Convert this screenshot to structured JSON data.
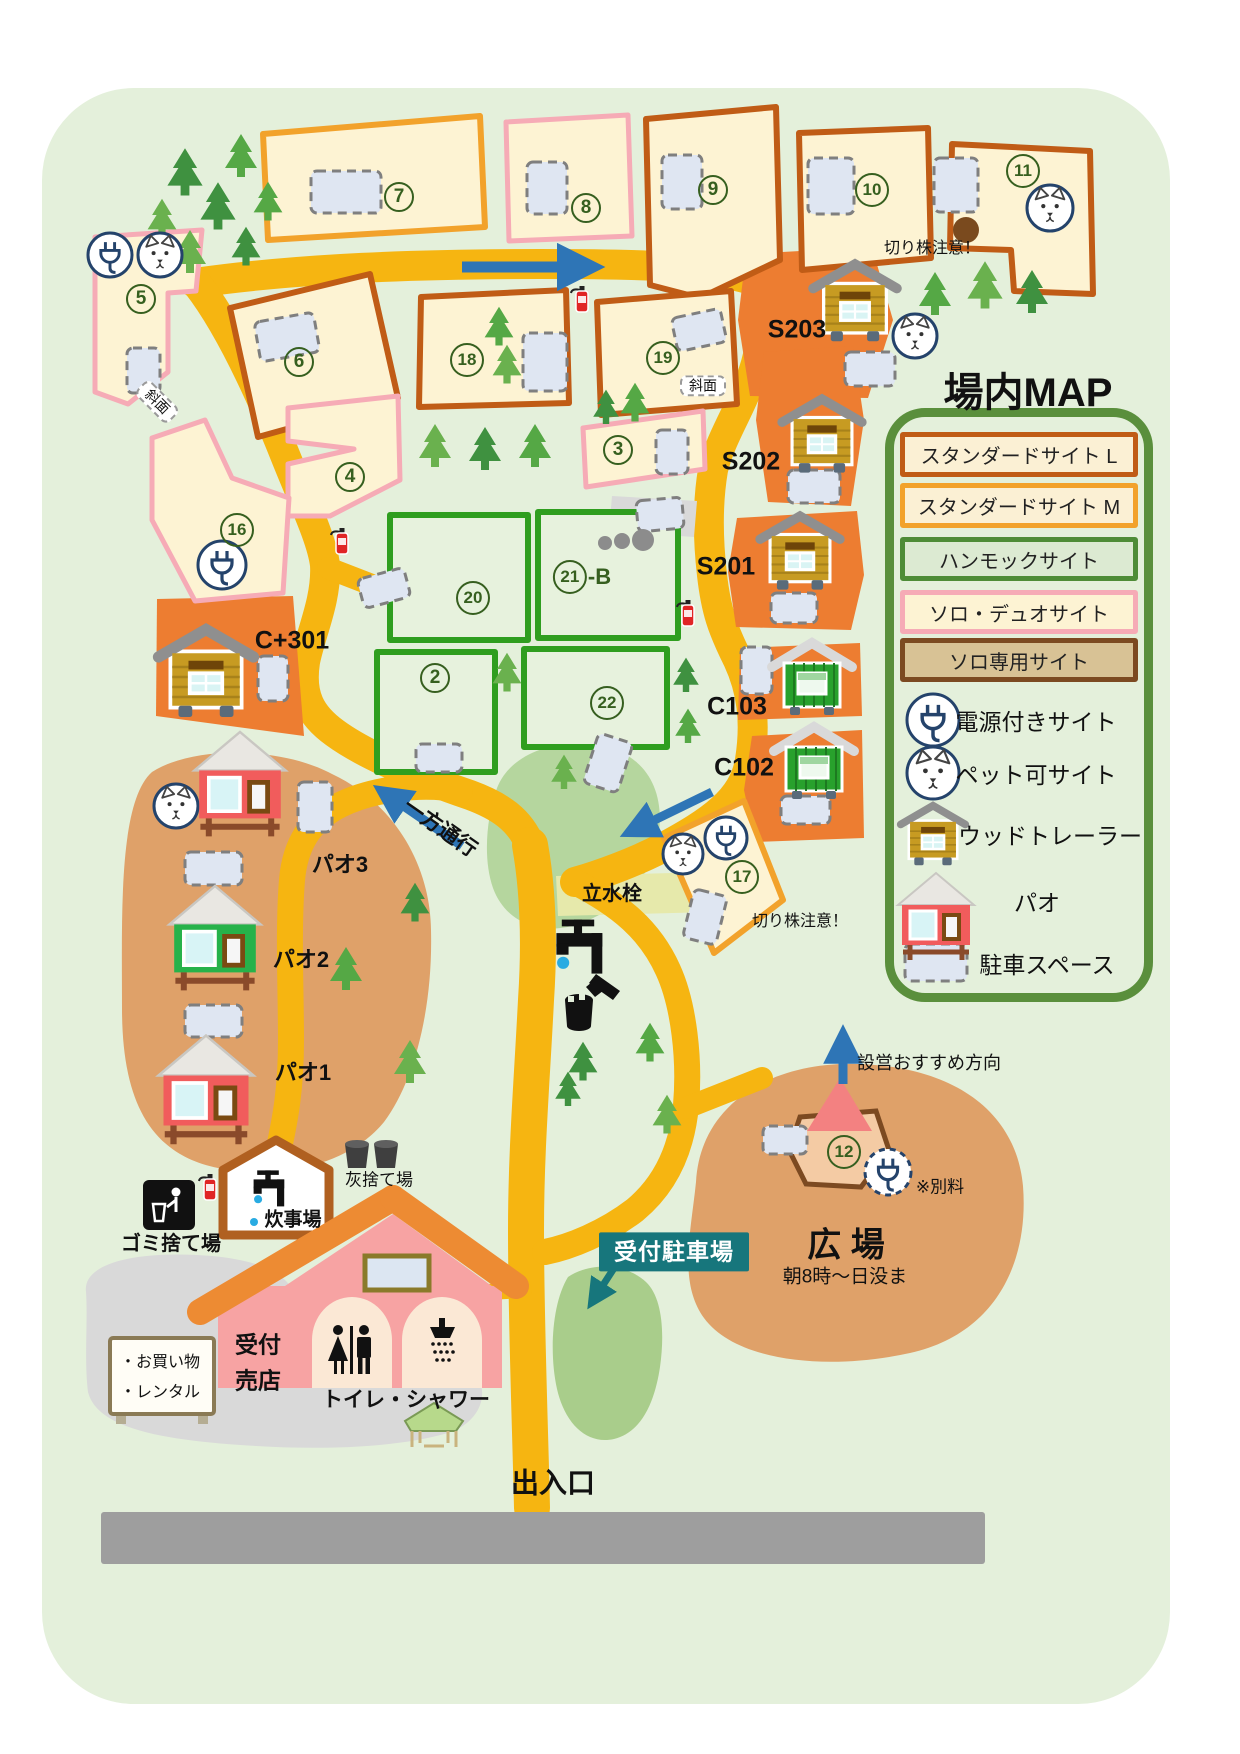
{
  "title": "場内MAP",
  "legend": {
    "items": [
      {
        "label": "スタンダードサイト L",
        "border": "#c05c16",
        "fill": "#fbf0d4"
      },
      {
        "label": "スタンダードサイト M",
        "border": "#f2a22b",
        "fill": "#fbf0d4"
      },
      {
        "label": "ハンモックサイト",
        "border": "#4e8c37",
        "fill": "#dcead2"
      },
      {
        "label": "ソロ・デュオサイト",
        "border": "#f6abb6",
        "fill": "#fdf3d3"
      },
      {
        "label": "ソロ専用サイト",
        "border": "#7c4a21",
        "fill": "#d8c295"
      }
    ],
    "icon_items": [
      {
        "icon": "power-plug-icon",
        "label": "電源付きサイト"
      },
      {
        "icon": "dog-icon",
        "label": "ペット可サイト"
      },
      {
        "icon": "wood-trailer-icon",
        "label": "ウッドトレーラー"
      },
      {
        "icon": "pao-icon",
        "label": "パオ"
      },
      {
        "icon": "parking-icon",
        "label": "駐車スペース"
      }
    ]
  },
  "colors": {
    "map_background": "#e4f0db",
    "road": "#f6b511",
    "arrow_blue": "#2e75b6",
    "teal": "#17767c",
    "trailer_patch": "#ed7d31",
    "pao_area": "#dfa169",
    "plaza_area": "#dfa169",
    "parking_fill": "#dfe6f2",
    "bottom_road": "#9e9e9e"
  },
  "sites": [
    {
      "n": "7",
      "x": 399,
      "y": 197
    },
    {
      "n": "8",
      "x": 586,
      "y": 208
    },
    {
      "n": "9",
      "x": 713,
      "y": 190
    },
    {
      "n": "10",
      "x": 872,
      "y": 190
    },
    {
      "n": "11",
      "x": 1023,
      "y": 171
    },
    {
      "n": "5",
      "x": 141,
      "y": 299
    },
    {
      "n": "6",
      "x": 299,
      "y": 362
    },
    {
      "n": "4",
      "x": 350,
      "y": 477
    },
    {
      "n": "16",
      "x": 237,
      "y": 530
    },
    {
      "n": "18",
      "x": 467,
      "y": 360
    },
    {
      "n": "19",
      "x": 663,
      "y": 358
    },
    {
      "n": "3",
      "x": 618,
      "y": 450
    },
    {
      "n": "20",
      "x": 473,
      "y": 598
    },
    {
      "n": "21",
      "sfx": "-B",
      "x": 582,
      "y": 577
    },
    {
      "n": "2",
      "x": 435,
      "y": 678
    },
    {
      "n": "22",
      "x": 607,
      "y": 703
    },
    {
      "n": "17",
      "x": 742,
      "y": 877
    },
    {
      "n": "12",
      "x": 844,
      "y": 1152
    }
  ],
  "labels": [
    {
      "id": "map-title",
      "t": "場内MAP",
      "x": 1028,
      "y": 393,
      "s": 40,
      "w": 700
    },
    {
      "id": "site-s203-label",
      "t": "S203",
      "x": 797,
      "y": 330,
      "s": 25,
      "w": 700
    },
    {
      "id": "site-s202-label",
      "t": "S202",
      "x": 751,
      "y": 462,
      "s": 25,
      "w": 700
    },
    {
      "id": "site-s201-label",
      "t": "S201",
      "x": 726,
      "y": 567,
      "s": 25,
      "w": 700
    },
    {
      "id": "site-c103-label",
      "t": "C103",
      "x": 737,
      "y": 707,
      "s": 25,
      "w": 700
    },
    {
      "id": "site-c102-label",
      "t": "C102",
      "x": 744,
      "y": 768,
      "s": 25,
      "w": 700
    },
    {
      "id": "site-c301-label",
      "t": "C+301",
      "x": 292,
      "y": 641,
      "s": 25,
      "w": 700
    },
    {
      "id": "pao3-label",
      "t": "パオ3",
      "x": 340,
      "y": 865,
      "s": 22,
      "w": 700
    },
    {
      "id": "pao2-label",
      "t": "パオ2",
      "x": 301,
      "y": 960,
      "s": 22,
      "w": 700
    },
    {
      "id": "pao1-label",
      "t": "パオ1",
      "x": 303,
      "y": 1073,
      "s": 22,
      "w": 700
    },
    {
      "id": "stump-warning-top",
      "t": "切り株注意！",
      "x": 932,
      "y": 249,
      "s": 16,
      "w": 400
    },
    {
      "id": "stump-warning-bottom",
      "t": "切り株注意！",
      "x": 800,
      "y": 922,
      "s": 16,
      "w": 400
    },
    {
      "id": "slope-note-site5",
      "t": "斜面",
      "x": 157,
      "y": 402,
      "s": 14,
      "w": 400,
      "rot": 45,
      "boxed": true
    },
    {
      "id": "slope-note-site19",
      "t": "斜面",
      "x": 703,
      "y": 386,
      "s": 14,
      "w": 400,
      "boxed": true
    },
    {
      "id": "one-way-label",
      "t": "一方通行",
      "x": 440,
      "y": 828,
      "s": 21,
      "w": 700,
      "rot": 35
    },
    {
      "id": "standpipe-label",
      "t": "立水栓",
      "x": 612,
      "y": 894,
      "s": 20,
      "w": 700
    },
    {
      "id": "setup-direction-label",
      "t": "設営おすすめ方向",
      "x": 929,
      "y": 1064,
      "s": 18,
      "w": 400
    },
    {
      "id": "extra-fee-note",
      "t": "※別料",
      "x": 940,
      "y": 1188,
      "s": 17,
      "w": 400
    },
    {
      "id": "plaza-label",
      "t": "広 場",
      "x": 846,
      "y": 1246,
      "s": 34,
      "w": 700
    },
    {
      "id": "plaza-hours",
      "t": "朝8時～日没ま",
      "x": 845,
      "y": 1278,
      "s": 19,
      "w": 400
    },
    {
      "id": "reception-parking-badge",
      "t": "受付駐車場",
      "x": 674,
      "y": 1252,
      "s": 23,
      "w": 700,
      "badge": true
    },
    {
      "id": "trash-area-label",
      "t": "ゴミ捨て場",
      "x": 171,
      "y": 1244,
      "s": 20,
      "w": 700
    },
    {
      "id": "cooking-area-label",
      "t": "炊事場",
      "x": 293,
      "y": 1221,
      "s": 19,
      "w": 700
    },
    {
      "id": "ash-area-label",
      "t": "灰捨て場",
      "x": 379,
      "y": 1181,
      "s": 17,
      "w": 400
    },
    {
      "id": "reception-label",
      "t": "受付",
      "x": 258,
      "y": 1345,
      "s": 23,
      "w": 700
    },
    {
      "id": "shop-label",
      "t": "売店",
      "x": 258,
      "y": 1381,
      "s": 23,
      "w": 700
    },
    {
      "id": "sign-shopping",
      "t": "・お買い物",
      "x": 120,
      "y": 1363,
      "s": 16,
      "w": 400,
      "anchor": "left"
    },
    {
      "id": "sign-rental",
      "t": "・レンタル",
      "x": 120,
      "y": 1393,
      "s": 16,
      "w": 400,
      "anchor": "left"
    },
    {
      "id": "toilet-shower-label",
      "t": "トイレ・シャワー",
      "x": 406,
      "y": 1400,
      "s": 21,
      "w": 700
    },
    {
      "id": "entrance-label",
      "t": "出入口",
      "x": 553,
      "y": 1484,
      "s": 28,
      "w": 700
    }
  ],
  "map_features": {
    "trees": [
      [
        185,
        179,
        1.1
      ],
      [
        241,
        162,
        1.0
      ],
      [
        162,
        224,
        0.9
      ],
      [
        218,
        213,
        1.1
      ],
      [
        268,
        207,
        0.9
      ],
      [
        190,
        258,
        1.0
      ],
      [
        246,
        252,
        0.9
      ],
      [
        935,
        300,
        1.0
      ],
      [
        985,
        292,
        1.1
      ],
      [
        1032,
        298,
        1.0
      ],
      [
        499,
        332,
        0.9
      ],
      [
        507,
        370,
        0.9
      ],
      [
        606,
        412,
        0.8
      ],
      [
        635,
        408,
        0.9
      ],
      [
        435,
        452,
        1.0
      ],
      [
        485,
        455,
        1.0
      ],
      [
        535,
        452,
        1.0
      ],
      [
        507,
        678,
        0.9
      ],
      [
        686,
        680,
        0.8
      ],
      [
        688,
        731,
        0.8
      ],
      [
        564,
        777,
        0.8
      ],
      [
        415,
        908,
        0.9
      ],
      [
        346,
        975,
        1.0
      ],
      [
        410,
        1068,
        1.0
      ],
      [
        583,
        1067,
        0.9
      ],
      [
        650,
        1048,
        0.9
      ],
      [
        667,
        1120,
        0.9
      ],
      [
        568,
        1094,
        0.8
      ]
    ],
    "parking_spaces": [
      [
        311,
        171,
        70,
        42,
        0
      ],
      [
        527,
        162,
        40,
        52,
        0
      ],
      [
        662,
        155,
        40,
        54,
        0
      ],
      [
        808,
        158,
        46,
        56,
        0
      ],
      [
        934,
        158,
        44,
        54,
        0
      ],
      [
        127,
        348,
        33,
        45,
        0
      ],
      [
        257,
        317,
        60,
        40,
        -10
      ],
      [
        523,
        333,
        44,
        58,
        0
      ],
      [
        674,
        313,
        50,
        34,
        -12
      ],
      [
        656,
        430,
        32,
        44,
        0
      ],
      [
        360,
        573,
        48,
        30,
        -15
      ],
      [
        637,
        499,
        46,
        31,
        -5
      ],
      [
        416,
        744,
        46,
        28,
        0
      ],
      [
        590,
        737,
        36,
        52,
        18
      ],
      [
        258,
        656,
        30,
        45,
        0
      ],
      [
        298,
        782,
        34,
        50,
        0
      ],
      [
        185,
        852,
        57,
        33,
        0
      ],
      [
        185,
        1005,
        57,
        32,
        0
      ],
      [
        845,
        352,
        50,
        34,
        0
      ],
      [
        788,
        470,
        52,
        33,
        0
      ],
      [
        771,
        593,
        46,
        30,
        0
      ],
      [
        741,
        647,
        31,
        47,
        0
      ],
      [
        781,
        796,
        49,
        28,
        0
      ],
      [
        688,
        892,
        34,
        50,
        14
      ],
      [
        763,
        1126,
        44,
        28,
        0
      ],
      [
        905,
        944,
        62,
        37,
        0
      ]
    ],
    "power_plug_badges": [
      [
        110,
        255,
        22
      ],
      [
        222,
        565,
        24
      ],
      [
        726,
        838,
        21
      ],
      [
        933,
        720,
        26
      ],
      [
        888,
        1172,
        23,
        "dashed"
      ]
    ],
    "pet_dog_badges": [
      [
        160,
        255,
        22
      ],
      [
        1050,
        208,
        23
      ],
      [
        915,
        336,
        22
      ],
      [
        683,
        854,
        20
      ],
      [
        176,
        806,
        22
      ],
      [
        933,
        773,
        26
      ]
    ],
    "fire_extinguishers": [
      [
        582,
        300
      ],
      [
        342,
        542
      ],
      [
        688,
        614
      ],
      [
        210,
        1188
      ]
    ],
    "stones": [
      [
        605,
        543,
        7
      ],
      [
        622,
        541,
        8
      ],
      [
        643,
        540,
        11
      ]
    ],
    "stump": [
      966,
      230,
      13
    ],
    "cabins": [
      {
        "t": "wt",
        "x": 855,
        "y": 306,
        "s": 1.1
      },
      {
        "t": "wt",
        "x": 822,
        "y": 439,
        "s": 1.05
      },
      {
        "t": "wt",
        "x": 800,
        "y": 556,
        "s": 1.05
      },
      {
        "t": "wt",
        "x": 206,
        "y": 677,
        "s": 1.25
      },
      {
        "t": "wt",
        "x": 933,
        "y": 838,
        "s": 0.85
      },
      {
        "t": "gc",
        "x": 812,
        "y": 679,
        "s": 1.0
      },
      {
        "t": "gc",
        "x": 814,
        "y": 763,
        "s": 1.0
      },
      {
        "t": "pr",
        "x": 240,
        "y": 768,
        "s": 1.2
      },
      {
        "t": "pg",
        "x": 215,
        "y": 922,
        "s": 1.2
      },
      {
        "t": "pr",
        "x": 206,
        "y": 1073,
        "s": 1.25
      },
      {
        "t": "pr",
        "x": 936,
        "y": 903,
        "s": 1.0
      }
    ]
  }
}
